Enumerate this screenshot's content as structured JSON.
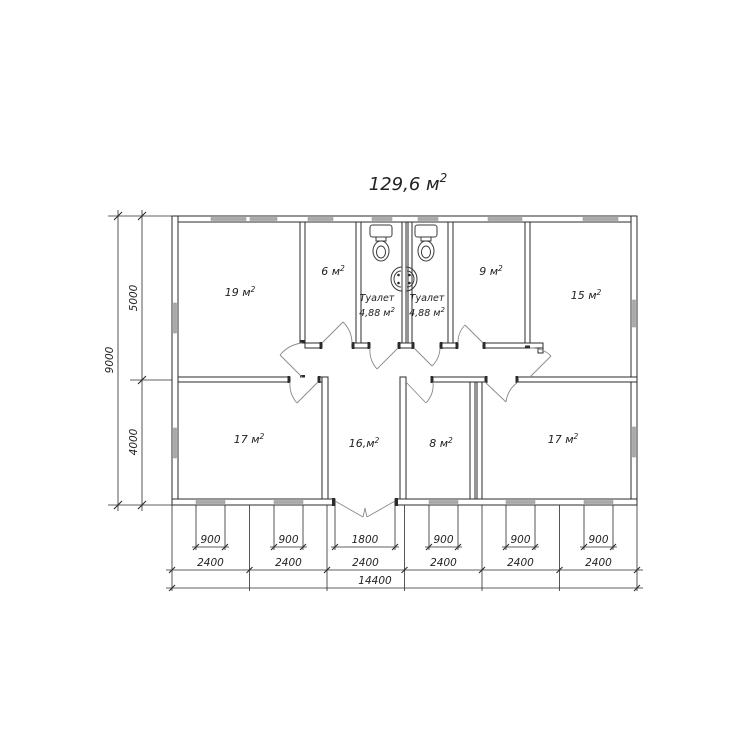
{
  "title": {
    "text": "129,6 м",
    "sup": "2"
  },
  "floor_plan": {
    "rooms": {
      "r19": {
        "label": "19 м",
        "sup": "2"
      },
      "r6": {
        "label": "6 м",
        "sup": "2"
      },
      "toilet1": {
        "name": "Туалет",
        "area": "4,88 м",
        "sup": "2"
      },
      "toilet2": {
        "name": "Туалет",
        "area": "4,88 м",
        "sup": "2"
      },
      "r9": {
        "label": "9 м",
        "sup": "2"
      },
      "r15": {
        "label": "15 м",
        "sup": "2"
      },
      "r17_left": {
        "label": "17 м",
        "sup": "2"
      },
      "hall": {
        "label": "16,м",
        "sup": "2"
      },
      "r8": {
        "label": "8 м",
        "sup": "2"
      },
      "r17_right": {
        "label": "17 м",
        "sup": "2"
      }
    },
    "dimensions": {
      "height_total": "9000",
      "height_top": "5000",
      "height_bottom": "4000",
      "openings": [
        "900",
        "900",
        "1800",
        "900",
        "900",
        "900"
      ],
      "modules": [
        "2400",
        "2400",
        "2400",
        "2400",
        "2400",
        "2400"
      ],
      "width_total": "14400"
    },
    "colors": {
      "line": "#2b2b2b",
      "window_fill": "#a9a9a9"
    }
  }
}
